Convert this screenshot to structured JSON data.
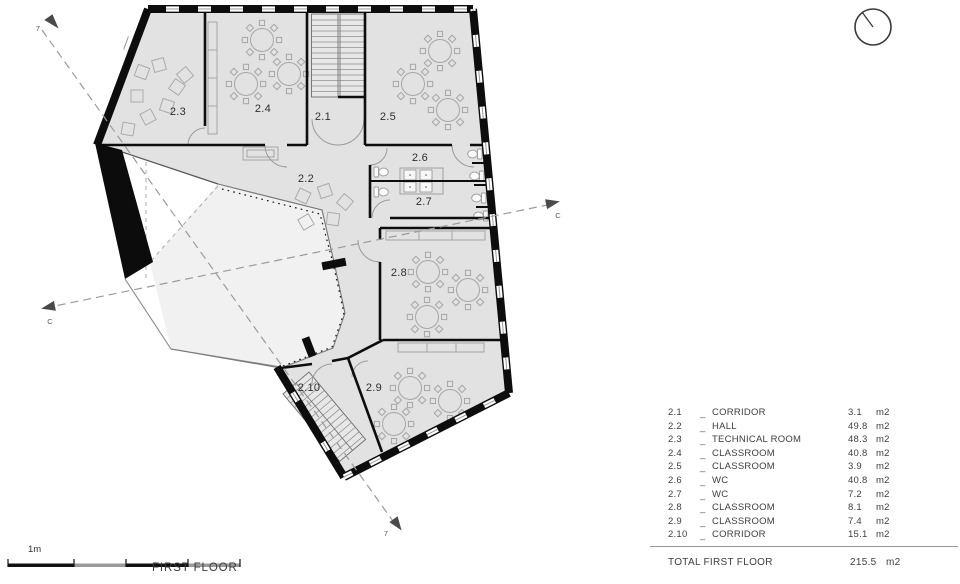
{
  "titles": {
    "floor_title": "FIRST FLOOR",
    "scale_label": "1m"
  },
  "plan": {
    "room_labels": [
      "2.1",
      "2.2",
      "2.3",
      "2.4",
      "2.5",
      "2.6",
      "2.7",
      "2.8",
      "2.9",
      "2.10"
    ],
    "section_label_c": "C",
    "section_label_7": "7",
    "colors": {
      "floor": "#e2e2e2",
      "void_floor": "#f1f1f1",
      "wall": "#0d0d0d",
      "dash": "#9b9b9b"
    }
  },
  "legend": {
    "rows": [
      {
        "number": "2.1",
        "sep": "_",
        "name": "CORRIDOR",
        "area": "3.1",
        "unit": "m2"
      },
      {
        "number": "2.2",
        "sep": "_",
        "name": "HALL",
        "area": "49.8",
        "unit": "m2"
      },
      {
        "number": "2.3",
        "sep": "_",
        "name": "TECHNICAL ROOM",
        "area": "48.3",
        "unit": "m2"
      },
      {
        "number": "2.4",
        "sep": "_",
        "name": "CLASSROOM",
        "area": "40.8",
        "unit": "m2"
      },
      {
        "number": "2.5",
        "sep": "_",
        "name": "CLASSROOM",
        "area": "3.9",
        "unit": "m2"
      },
      {
        "number": "2.6",
        "sep": "_",
        "name": "WC",
        "area": "40.8",
        "unit": "m2"
      },
      {
        "number": "2.7",
        "sep": "_",
        "name": "WC",
        "area": "7.2",
        "unit": "m2"
      },
      {
        "number": "2.8",
        "sep": "_",
        "name": "CLASSROOM",
        "area": "8.1",
        "unit": "m2"
      },
      {
        "number": "2.9",
        "sep": "_",
        "name": "CLASSROOM",
        "area": "7.4",
        "unit": "m2"
      },
      {
        "number": "2.10",
        "sep": "_",
        "name": "CORRIDOR",
        "area": "15.1",
        "unit": "m2"
      }
    ],
    "total": {
      "label": "TOTAL FIRST FLOOR",
      "area": "215.5",
      "unit": "m2"
    }
  }
}
